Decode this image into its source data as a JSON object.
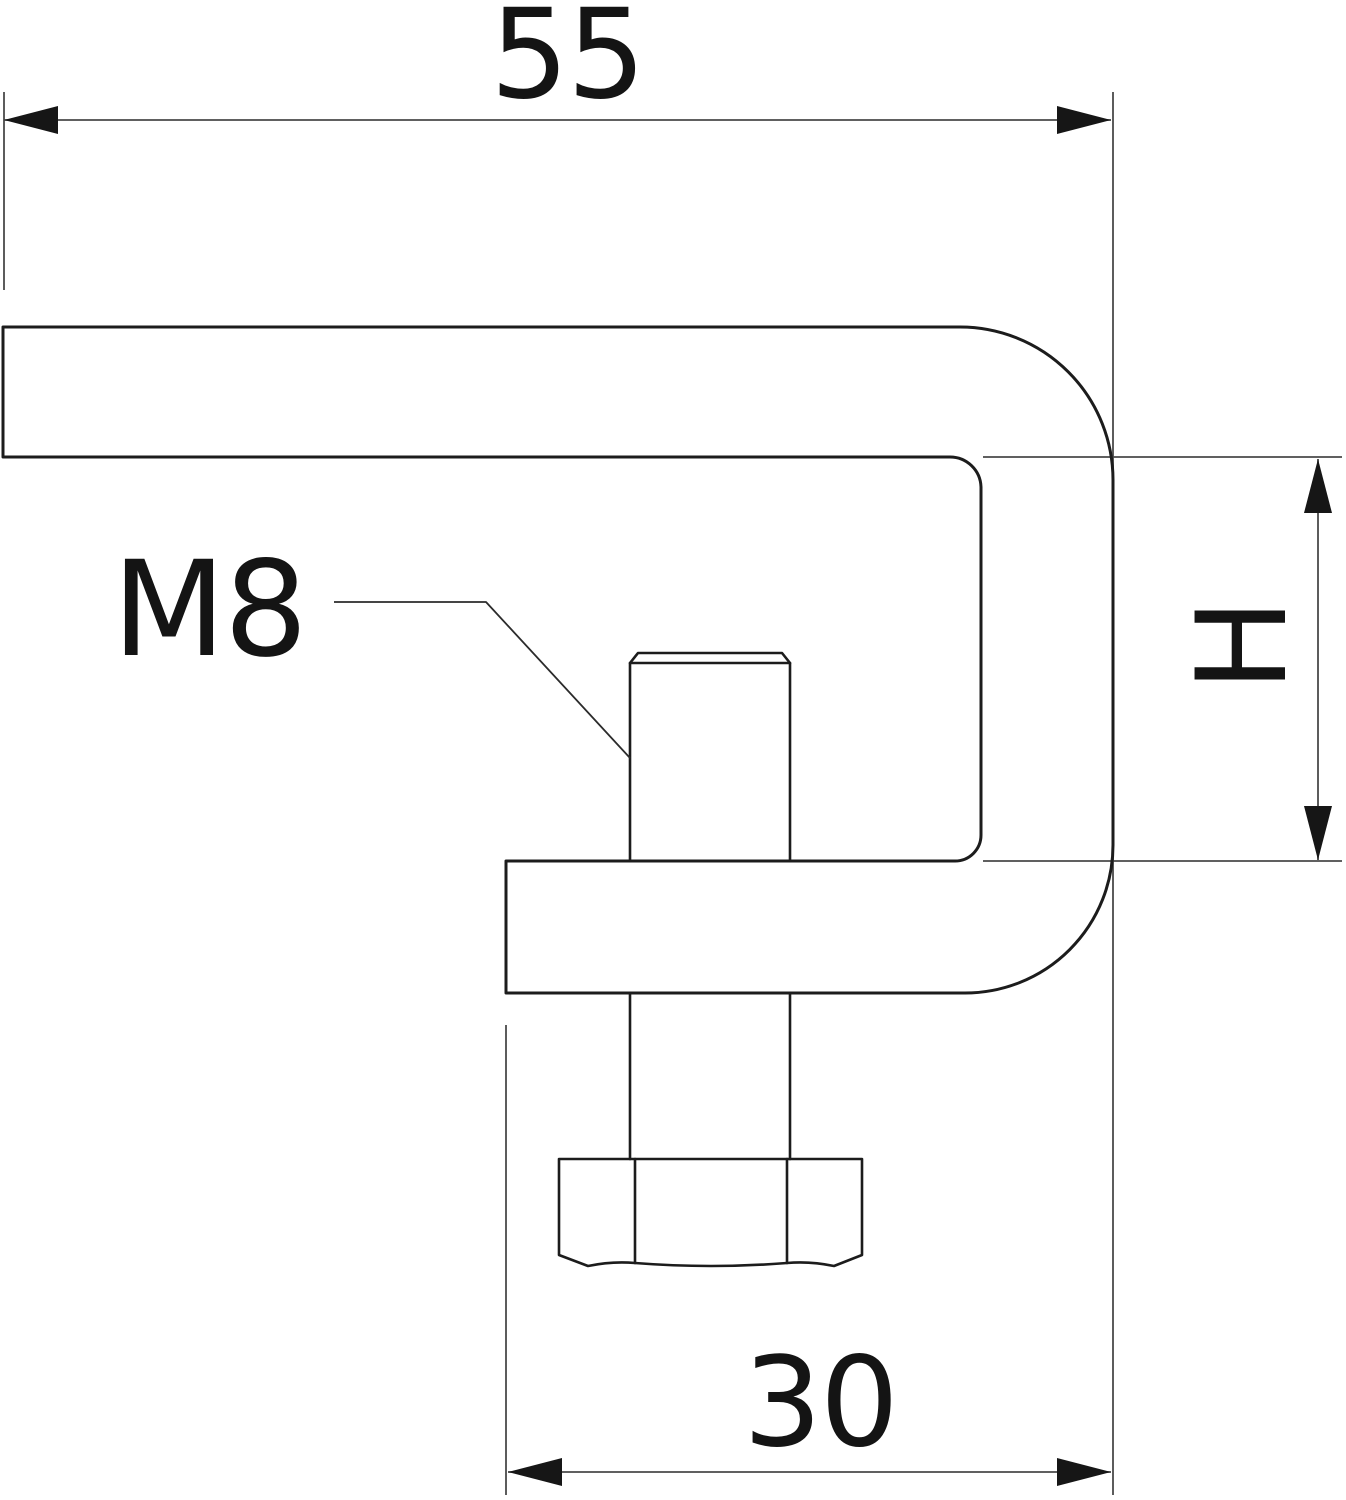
{
  "drawing": {
    "kind": "technical-drawing",
    "subject": "beam-clamp side profile with hex-head screw",
    "labels": {
      "top_width": "55",
      "thread_size": "M8",
      "inner_height": "H",
      "bottom_width": "30"
    },
    "dimensions": {
      "top_width_mm": 55,
      "bottom_width_mm": 30,
      "inner_height_symbol": "H",
      "screw_thread": "M8"
    },
    "colors": {
      "background": "#ffffff",
      "part_outline": "#1c1c1c",
      "dimension_lines": "#4a4a4a",
      "arrowheads": "#161616",
      "text": "#141414"
    }
  }
}
